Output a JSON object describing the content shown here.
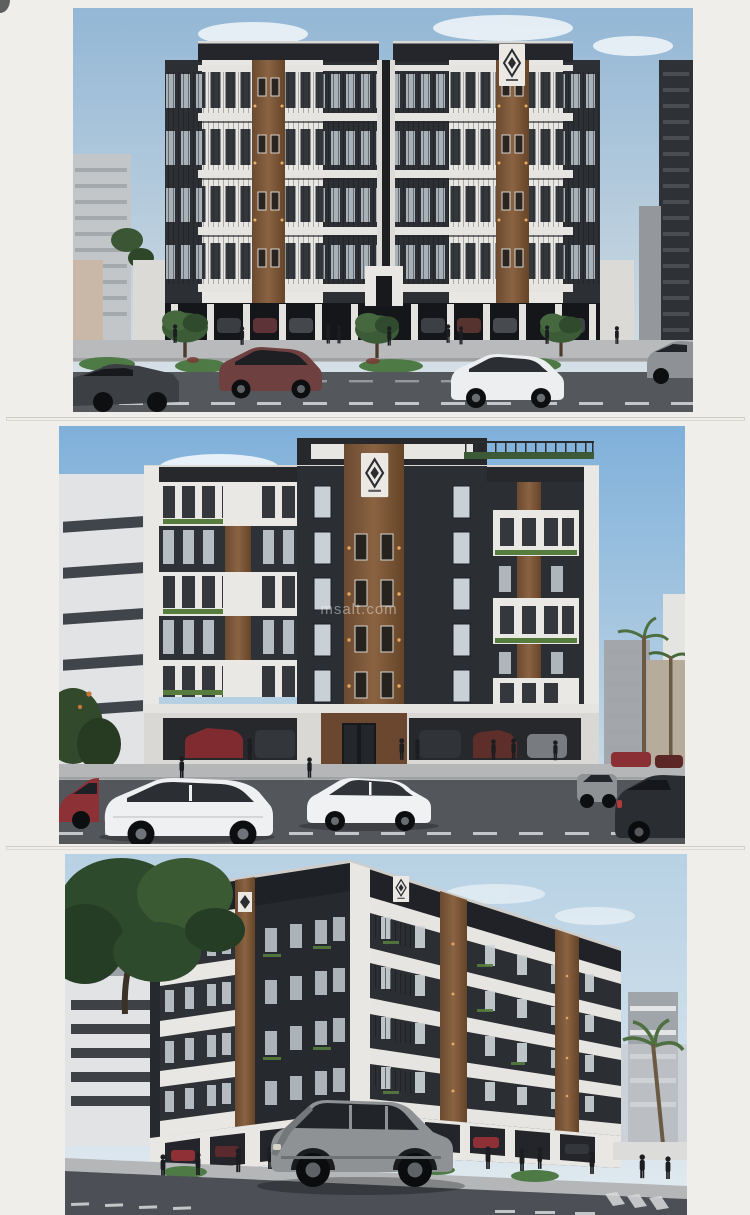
{
  "gallery": {
    "watermark": {
      "text": "msalt.com"
    },
    "photos": [
      {
        "name": "front-elevation-wide",
        "logo_icon": "diamond-emblem-icon"
      },
      {
        "name": "front-elevation-close",
        "logo_icon": "diamond-emblem-icon"
      },
      {
        "name": "corner-perspective",
        "logo_icon": "diamond-emblem-icon"
      }
    ],
    "colors": {
      "page_bg": "#f0eeeb",
      "card_border": "#d7d3ce",
      "facade_dark": "#2b2e33",
      "facade_white": "#eae8e4",
      "wood_accent": "#7b5a3d",
      "sky_top": "#8fb6d8",
      "road": "#53565c",
      "greenery": "#45633c",
      "car_red": "#8c3136",
      "car_white": "#eef0f1"
    }
  }
}
